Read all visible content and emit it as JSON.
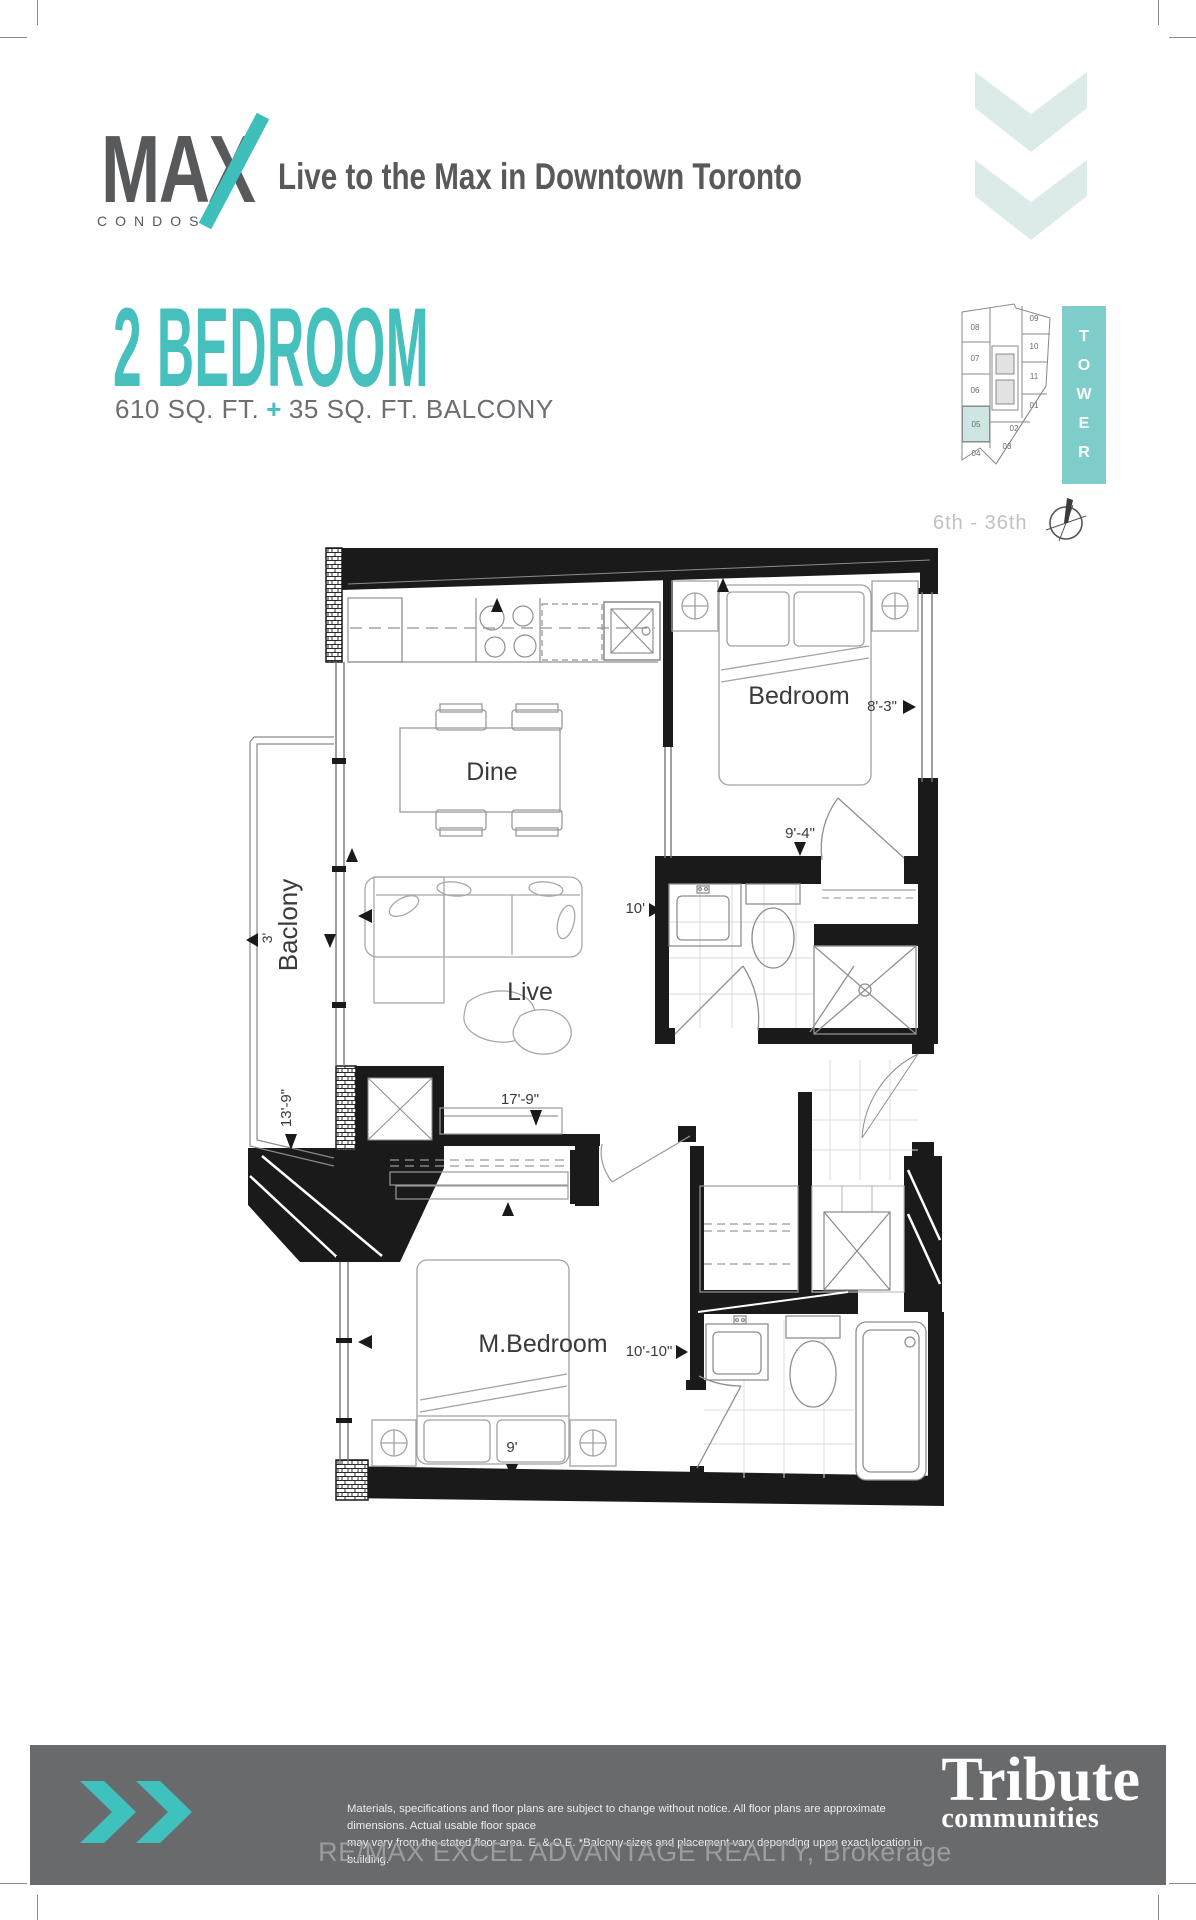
{
  "brand": {
    "name": "MAX",
    "sub": "CONDOS",
    "tagline": "Live to the Max in Downtown Toronto"
  },
  "heading": {
    "title": "2 BEDROOM",
    "area": "610 SQ. FT.",
    "plus": "+",
    "balcony_area": "35 SQ. FT. BALCONY"
  },
  "keyplan": {
    "tower_letters": [
      "T",
      "O",
      "W",
      "E",
      "R"
    ],
    "floors": "6th - 36th",
    "units": [
      "08",
      "09",
      "07",
      "10",
      "06",
      "11",
      "05",
      "01",
      "02",
      "03",
      "04"
    ],
    "highlight_unit": "05"
  },
  "plan": {
    "rooms": {
      "bedroom": "Bedroom",
      "dine": "Dine",
      "live": "Live",
      "balcony": "Baclony",
      "master": "M.Bedroom"
    },
    "dims": {
      "bedroom_width": "8'-3\"",
      "bedroom_depth": "9'-4\"",
      "bath_width": "10'",
      "living_width": "17'-9\"",
      "balcony_depth": "3'",
      "balcony_length": "13'-9\"",
      "master_width": "10'-10\"",
      "master_depth": "9'"
    }
  },
  "footer": {
    "disclaimer_line1": "Materials, specifications and floor plans are subject to change without notice. All floor plans are approximate dimensions. Actual usable floor space",
    "disclaimer_line2": "may vary from the stated floor area.  E. & O.E.  *Balcony sizes and placement vary depending upon exact location in building.",
    "brokerage": "RE/MAX EXCEL ADVANTAGE REALTY, Brokerage",
    "tribute_top": "Tribute",
    "tribute_bottom": "communities"
  },
  "colors": {
    "teal": "#3fbfbb",
    "pale_teal": "#dcebea",
    "dark_gray": "#58595b",
    "footer_gray": "#696a6c"
  }
}
